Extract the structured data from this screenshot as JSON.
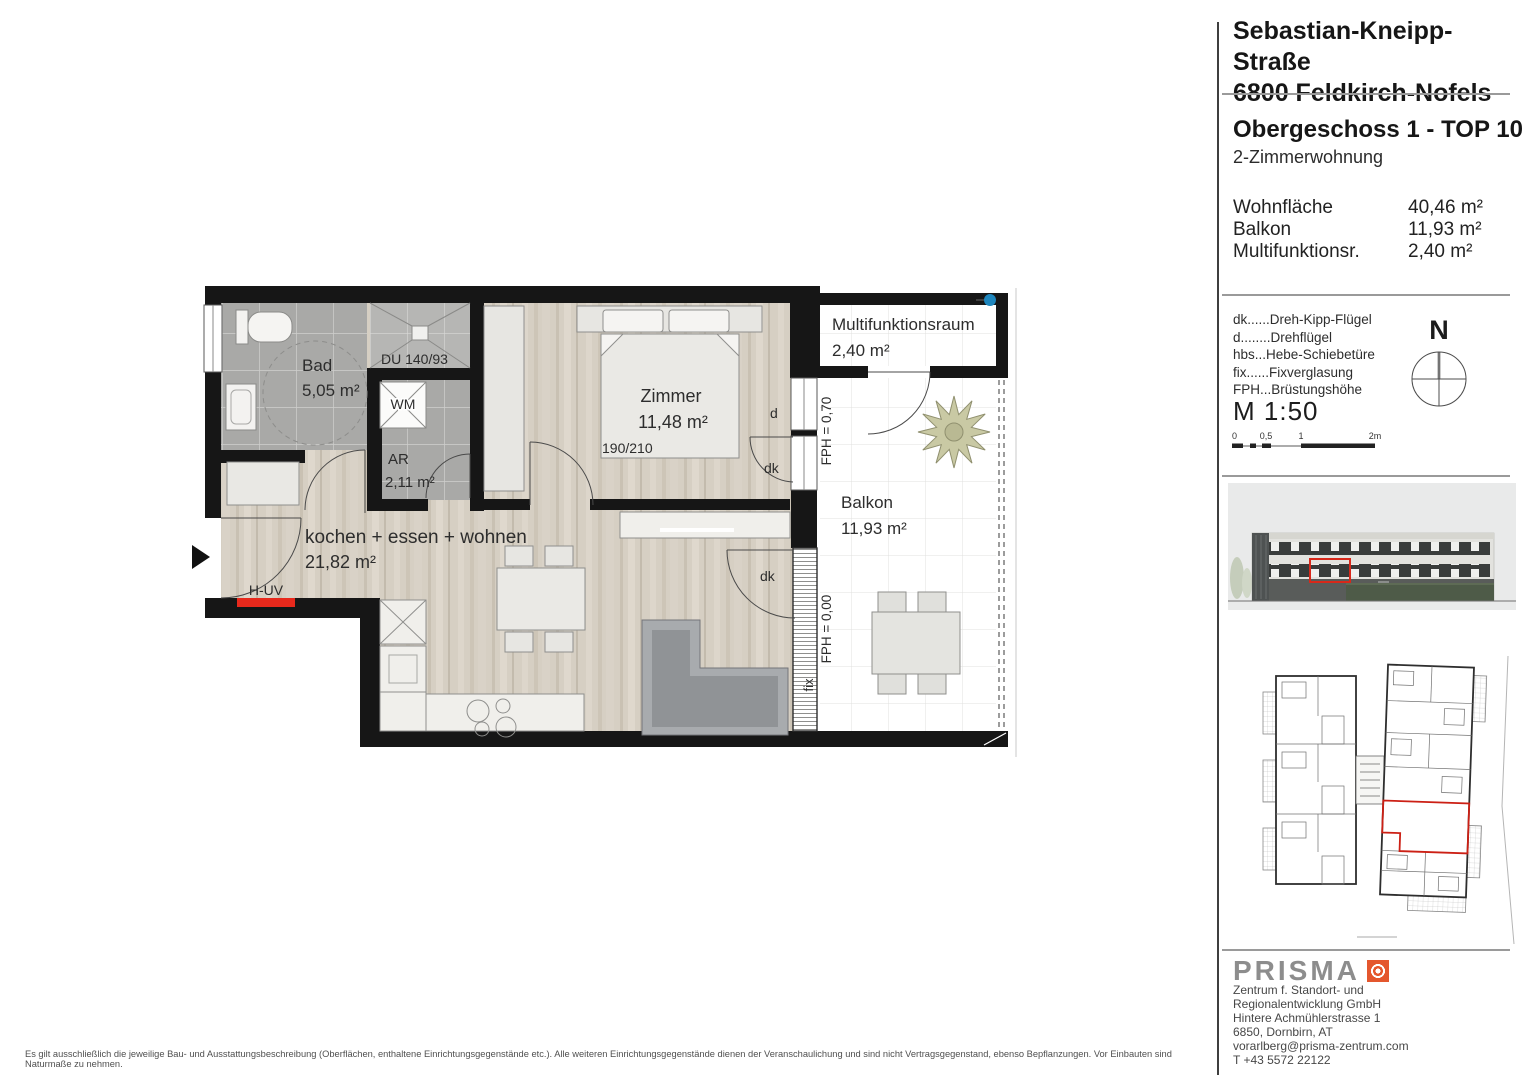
{
  "sidebar": {
    "address": {
      "line1": "Sebastian-Kneipp-Straße",
      "line2": "6800 Feldkirch-Nofels"
    },
    "unit": {
      "title": "Obergeschoss 1 - TOP 10",
      "subtitle": "2-Zimmerwohnung"
    },
    "areas": {
      "rows": [
        {
          "label": "Wohnfläche",
          "value": "40,46 m²"
        },
        {
          "label": "Balkon",
          "value": "11,93 m²"
        },
        {
          "label": "Multifunktionsr.",
          "value": "2,40 m²"
        }
      ]
    },
    "legend": {
      "items": [
        "dk......Dreh-Kipp-Flügel",
        "d........Drehflügel",
        "hbs...Hebe-Schiebetüre",
        "fix......Fixverglasung",
        "FPH...Brüstungshöhe"
      ]
    },
    "compass": {
      "north_label": "N"
    },
    "scale": {
      "label": "M 1:50",
      "ticks": [
        "0",
        "0,5",
        "1",
        "2m"
      ]
    },
    "contact": {
      "brand": "PRISMA",
      "lines": [
        "Zentrum f. Standort- und",
        "Regionalentwicklung GmbH",
        "Hintere Achmühlerstrasse 1",
        "6850, Dornbirn, AT",
        "vorarlberg@prisma-zentrum.com",
        "T +43 5572 22122"
      ]
    }
  },
  "plan": {
    "rooms": {
      "bad": {
        "name": "Bad",
        "area": "5,05 m²"
      },
      "ar": {
        "name": "AR",
        "area": "2,11 m²"
      },
      "zimmer": {
        "name": "Zimmer",
        "area": "11,48 m²"
      },
      "living": {
        "name": "kochen + essen + wohnen",
        "area": "21,82 m²"
      },
      "mfr": {
        "name": "Multifunktionsraum",
        "area": "2,40 m²"
      },
      "balkon": {
        "name": "Balkon",
        "area": "11,93 m²"
      }
    },
    "annotations": {
      "shower": "DU 140/93",
      "washer": "WM",
      "bed_size": "190/210",
      "huv": "H-UV",
      "fph_top": "FPH = 0,70",
      "fph_bottom": "FPH = 0,00",
      "fix": "fix",
      "d": "d",
      "dk_zimmer": "dk",
      "dk_living": "dk"
    },
    "colors": {
      "wall": "#161616",
      "highlight_red": "#e8291c",
      "marker_blue": "#1e86bd"
    }
  },
  "doc": {
    "disclaimer": "Es gilt ausschließlich die jeweilige Bau- und Ausstattungsbeschreibung (Oberflächen, enthaltene Einrichtungsgegenstände etc.). Alle weiteren Einrichtungsgegenstände dienen der Veranschaulichung und sind nicht Vertragsgegenstand, ebenso Bepflanzungen. Vor Einbauten sind Naturmaße zu nehmen."
  }
}
